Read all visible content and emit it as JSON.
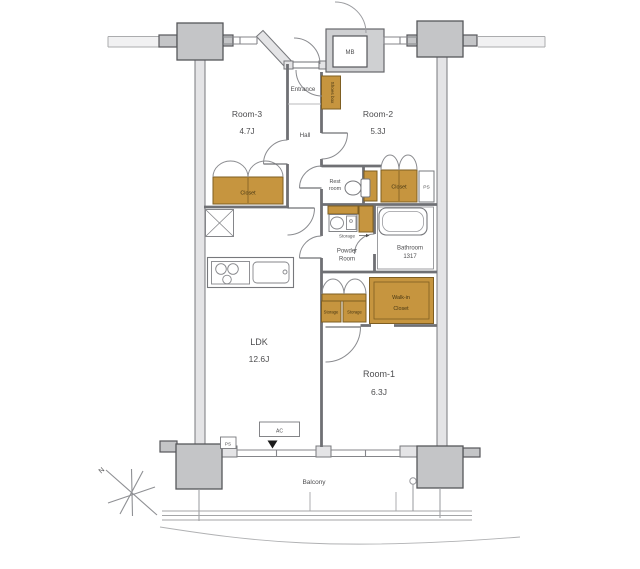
{
  "colors": {
    "wood": "#C6953F",
    "wood_border": "#7E5E22",
    "pillar": "#C4C5C7",
    "wall_fill": "#E4E4E6",
    "mb_fill": "#CFD0D2",
    "line": "#6F7074",
    "thin": "#8A8B8F",
    "text": "#4D4D4F"
  },
  "labels": {
    "mb": "MB",
    "entrance": "Entrance",
    "shoes_box": "Shoes box",
    "room3_name": "Room-3",
    "room3_size": "4.7J",
    "hall": "Hall",
    "room2_name": "Room-2",
    "room2_size": "5.3J",
    "rest_room_line1": "Rest",
    "rest_room_line2": "room",
    "room3_closet": "Closet",
    "room2_closet": "Closet",
    "ps_upper": "PS",
    "ps_lower": "PS",
    "storage_pointer": "Storage",
    "bathroom_name": "Bathroom",
    "bathroom_size": "1317",
    "powder_line1": "Powder",
    "powder_line2": "Room",
    "wic_line1": "Walk-in",
    "wic_line2": "Closet",
    "storage_left": "Storage",
    "storage_right": "Storage",
    "ldk_name": "LDK",
    "ldk_size": "12.6J",
    "room1_name": "Room-1",
    "room1_size": "6.3J",
    "ac": "AC",
    "balcony": "Balcony",
    "north": "N"
  }
}
